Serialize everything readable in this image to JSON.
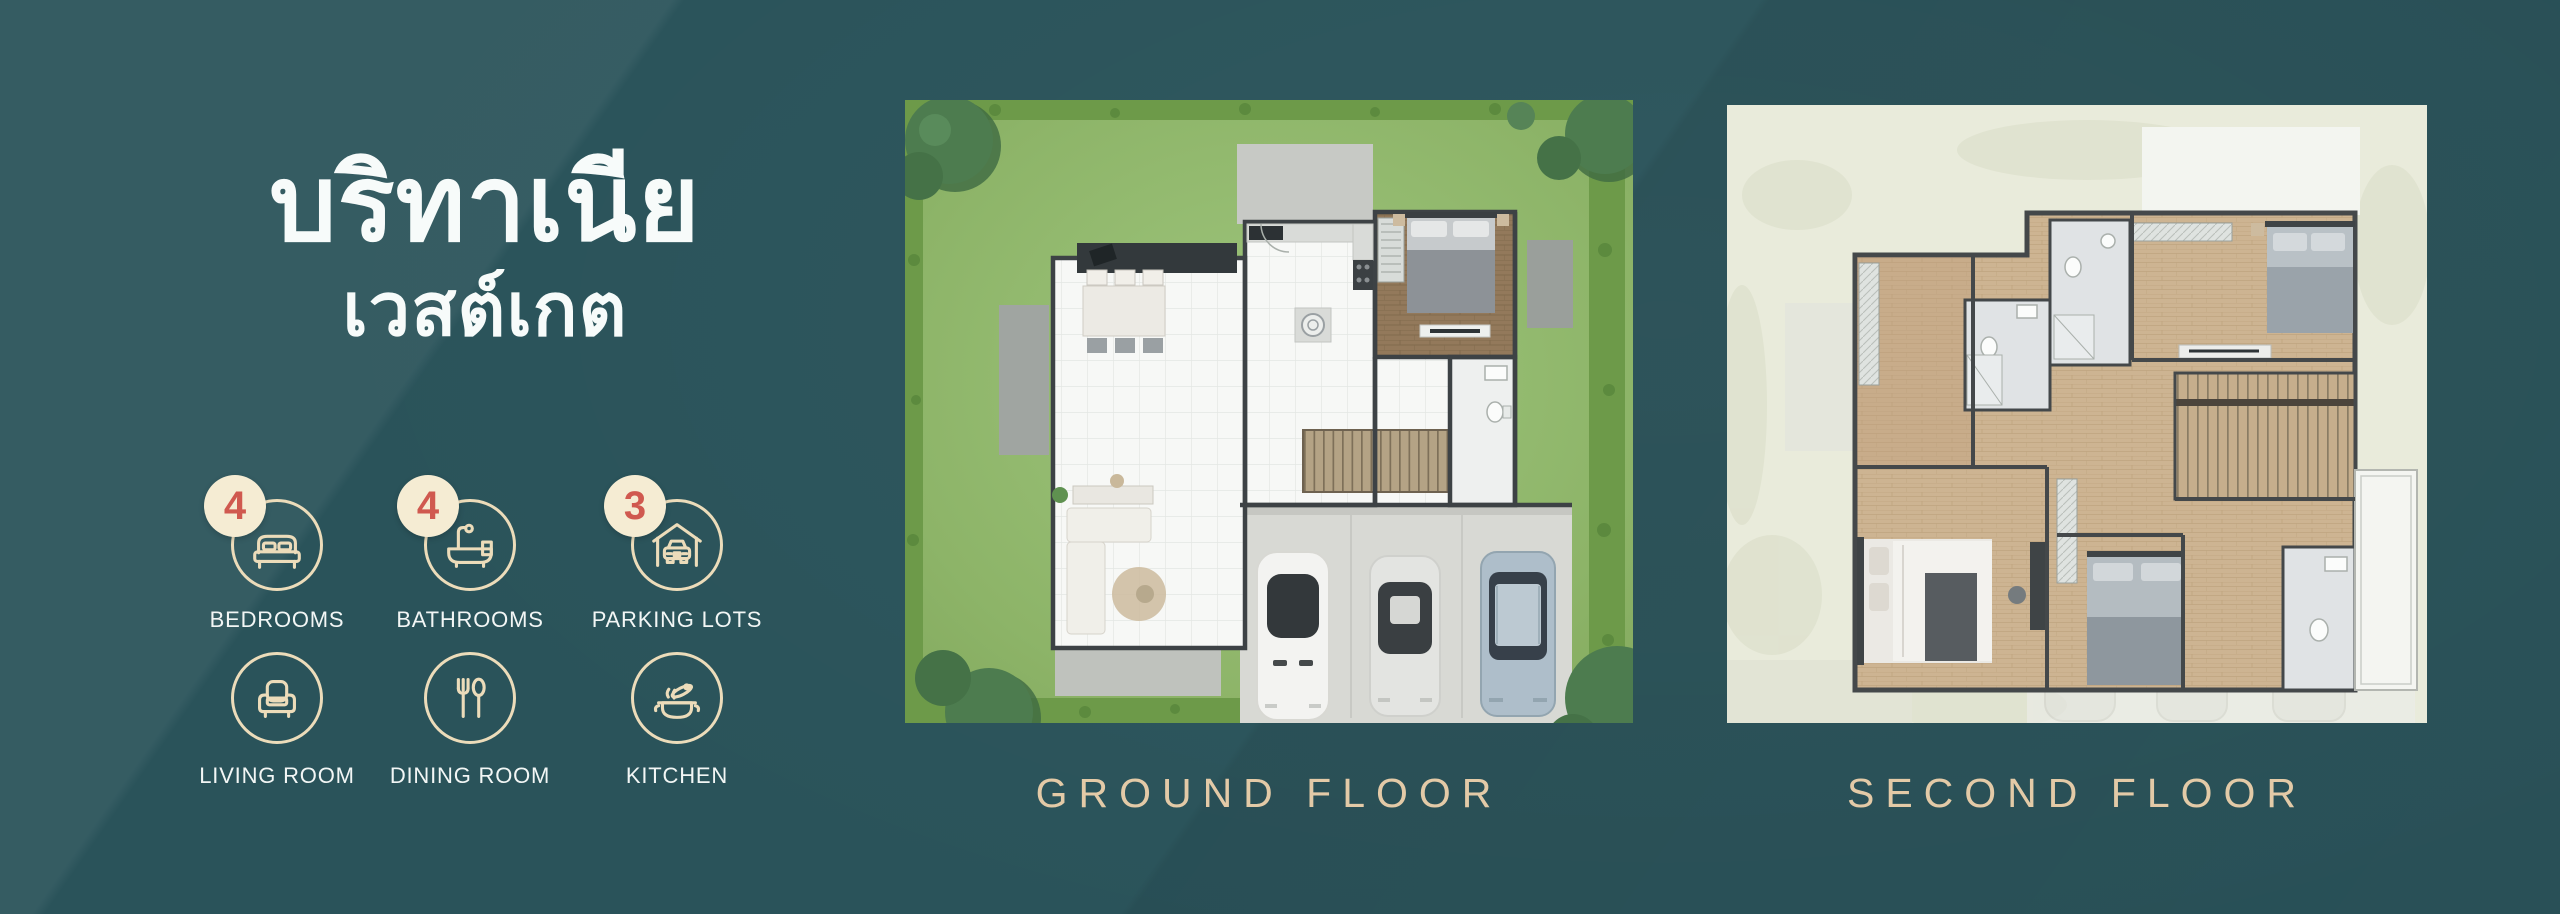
{
  "title": {
    "line1": "บริทาเนีย",
    "line2": "เวสต์เกต"
  },
  "features": [
    {
      "id": "bedrooms",
      "count": "4",
      "label": "BEDROOMS",
      "icon": "bed-icon"
    },
    {
      "id": "bathrooms",
      "count": "4",
      "label": "BATHROOMS",
      "icon": "bathtub-icon"
    },
    {
      "id": "parking-lots",
      "count": "3",
      "label": "PARKING LOTS",
      "icon": "car-garage-icon"
    },
    {
      "id": "living-room",
      "count": "",
      "label": "LIVING ROOM",
      "icon": "armchair-icon"
    },
    {
      "id": "dining-room",
      "count": "",
      "label": "DINING ROOM",
      "icon": "fork-spoon-icon"
    },
    {
      "id": "kitchen",
      "count": "",
      "label": "KITCHEN",
      "icon": "cooking-pot-icon"
    }
  ],
  "floor_plans": [
    {
      "id": "ground-floor",
      "label": "GROUND FLOOR"
    },
    {
      "id": "second-floor",
      "label": "SECOND FLOOR"
    }
  ],
  "colors": {
    "background_teal": "#2a535a",
    "title_text": "#f7fbfa",
    "badge_circle": "#f5ecd3",
    "badge_number": "#d0594f",
    "icon_outline": "#ecdcba",
    "feature_label": "#f2f6f5",
    "floor_label": "#e3caa7",
    "lawn_green": "#8db468",
    "plan_card_bg": "#e9ebdb"
  }
}
